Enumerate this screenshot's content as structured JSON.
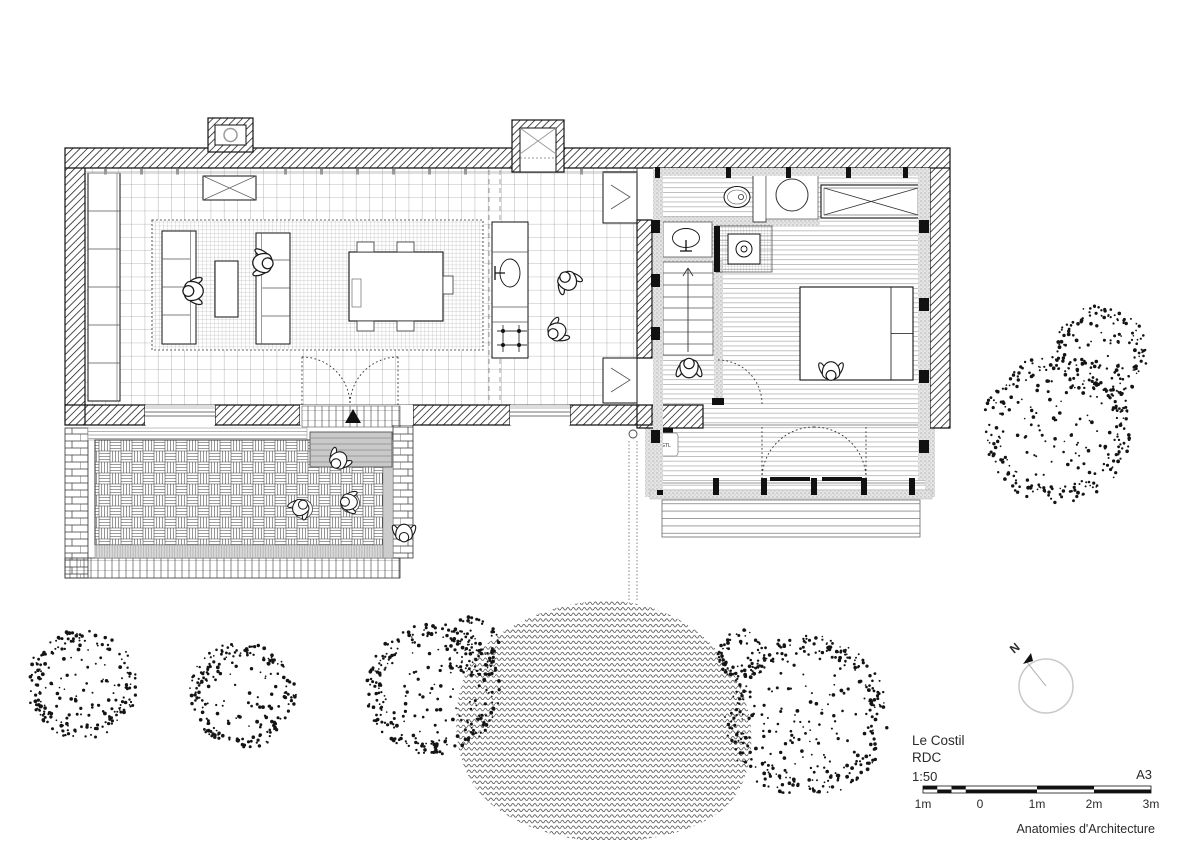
{
  "title_block": {
    "project": "Le Costil",
    "level": "RDC",
    "scale": "1:50",
    "sheet": "A3",
    "credit": "Anatomies d'Architecture"
  },
  "scale_bar": {
    "labels": [
      "1m",
      "0",
      "1m",
      "2m",
      "3m"
    ]
  },
  "north_arrow": {
    "label": "N"
  },
  "plan_labels": {
    "gtl": "GTL"
  },
  "colors": {
    "ink": "#1a1a1a",
    "paper": "#ffffff",
    "muted": "#9a9a9a"
  }
}
